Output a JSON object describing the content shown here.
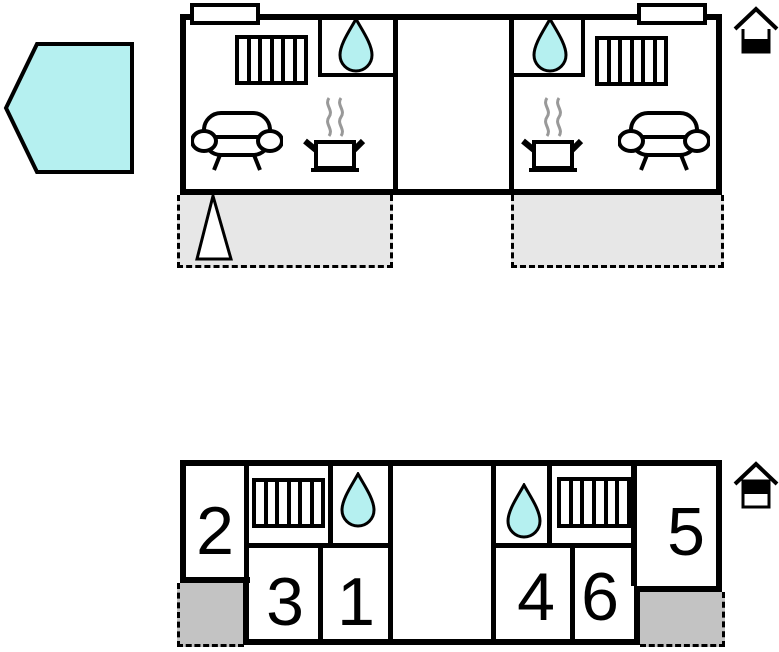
{
  "title": "holiday-home-floor-plan",
  "colors": {
    "highlight_cyan": "#b5f0f0",
    "terrace_grey": "#e7e7e7",
    "porch_grey": "#c3c3c3",
    "wall_black": "#000000",
    "steam_grey": "#999999"
  },
  "site_shape": {
    "icon": "pentagon-icon",
    "fill": "#b5f0f0"
  },
  "upper_plan": {
    "level_indicator": {
      "icon": "house-ground-floor-icon",
      "highlighted_band": "bottom"
    },
    "units": [
      {
        "side": "left",
        "icons": [
          "door-marker",
          "radiator-icon",
          "water-drop-icon",
          "sofa-icon",
          "cooking-pot-icon"
        ]
      },
      {
        "side": "right",
        "icons": [
          "door-marker",
          "water-drop-icon",
          "radiator-icon",
          "cooking-pot-icon",
          "sofa-icon"
        ]
      }
    ],
    "terraces": [
      {
        "side": "left",
        "icons": [
          "tree-triangle-icon"
        ]
      },
      {
        "side": "right",
        "icons": []
      }
    ]
  },
  "lower_plan": {
    "level_indicator": {
      "icon": "house-upper-floor-icon",
      "highlighted_band": "top"
    },
    "icons": [
      "radiator-icon",
      "water-drop-icon",
      "water-drop-icon",
      "radiator-icon"
    ],
    "rooms": [
      {
        "label": "2"
      },
      {
        "label": "3"
      },
      {
        "label": "1"
      },
      {
        "label": "4"
      },
      {
        "label": "6"
      },
      {
        "label": "5"
      }
    ]
  }
}
